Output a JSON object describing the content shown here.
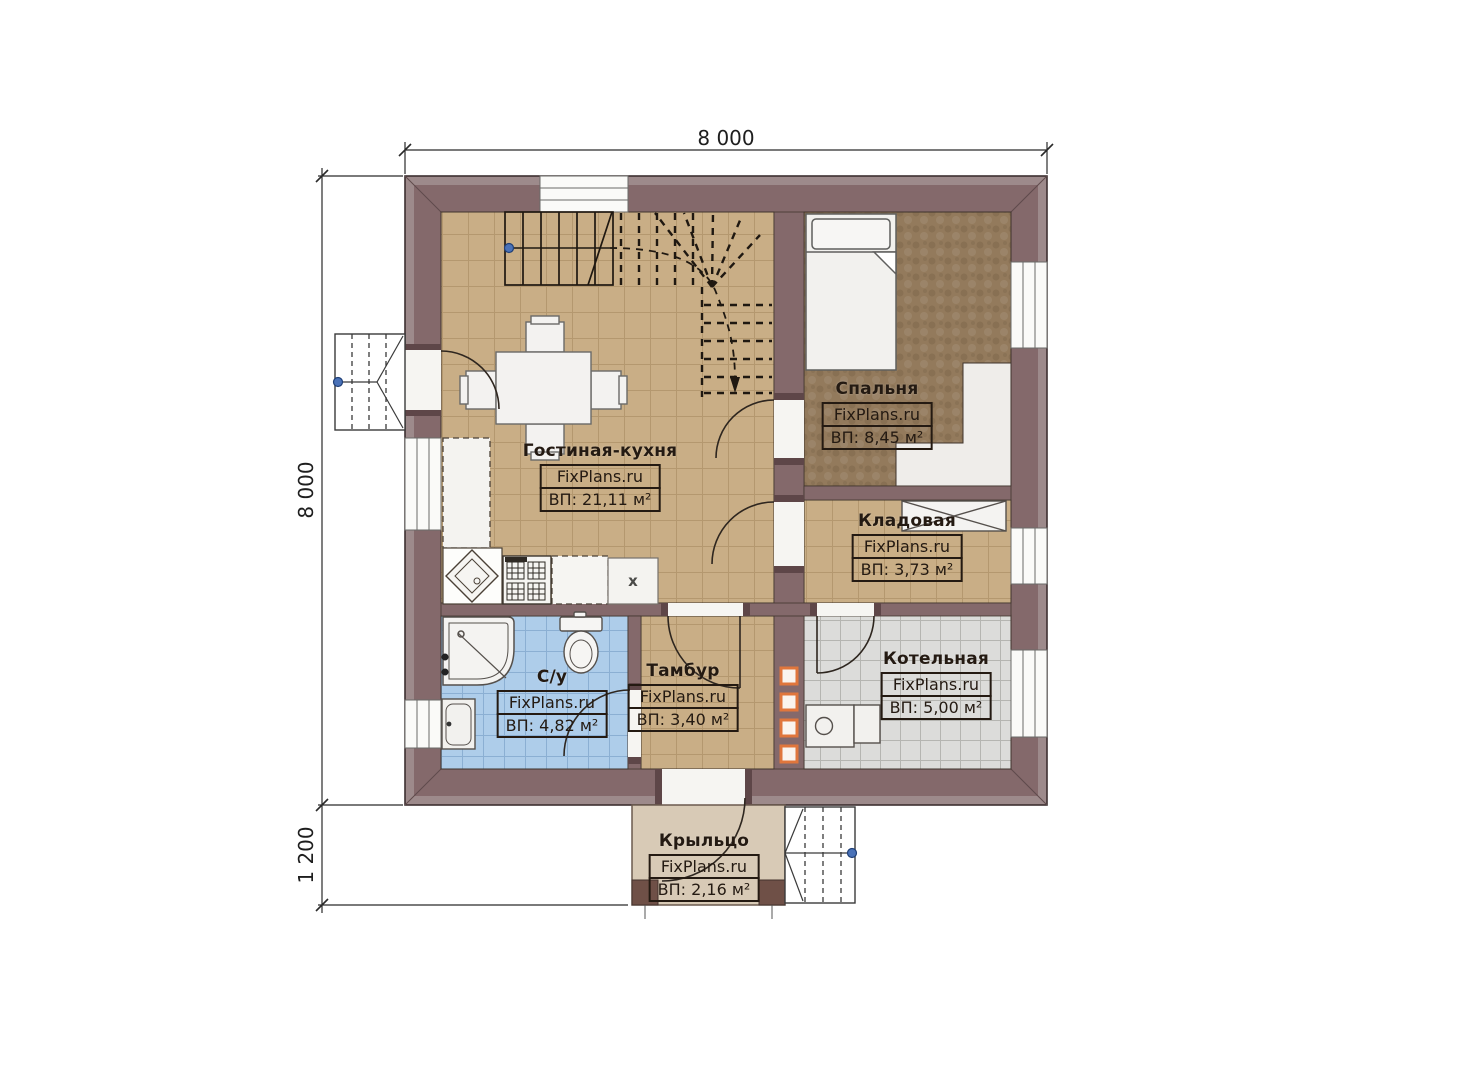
{
  "plan": {
    "type": "floor-plan",
    "source_watermark": "FixPlans.ru"
  },
  "dimensions": {
    "top_width": "8 000",
    "left_height": "8 000",
    "left_porch_depth": "1 200"
  },
  "rooms": [
    {
      "key": "living-kitchen",
      "name": "Гостиная-кухня",
      "brand": "FixPlans.ru",
      "area": "ВП: 21,11 м²"
    },
    {
      "key": "bedroom",
      "name": "Спальня",
      "brand": "FixPlans.ru",
      "area": "ВП: 8,45 м²"
    },
    {
      "key": "storage",
      "name": "Кладовая",
      "brand": "FixPlans.ru",
      "area": "ВП: 3,73 м²"
    },
    {
      "key": "bathroom",
      "name": "С/у",
      "brand": "FixPlans.ru",
      "area": "ВП: 4,82 м²"
    },
    {
      "key": "vestibule",
      "name": "Тамбур",
      "brand": "FixPlans.ru",
      "area": "ВП: 3,40 м²"
    },
    {
      "key": "boiler-room",
      "name": "Котельная",
      "brand": "FixPlans.ru",
      "area": "ВП: 5,00 м²"
    },
    {
      "key": "porch",
      "name": "Крыльцо",
      "brand": "FixPlans.ru",
      "area": "ВП: 2,16 м²"
    }
  ],
  "appliances": {
    "fridge_label": "x"
  },
  "colors": {
    "wall": "#84696b",
    "roof_overhang": "#9d8a8b",
    "floor_tile_tan": "#c9ae86",
    "floor_tile_blue": "#aecdea",
    "floor_tile_gray": "#dcdcda",
    "carpet": "#937a5c",
    "porch": "#d8cab6",
    "accent_orange": "#e0763c",
    "marker_blue": "#4a72b8",
    "label_ink": "#241a12"
  }
}
